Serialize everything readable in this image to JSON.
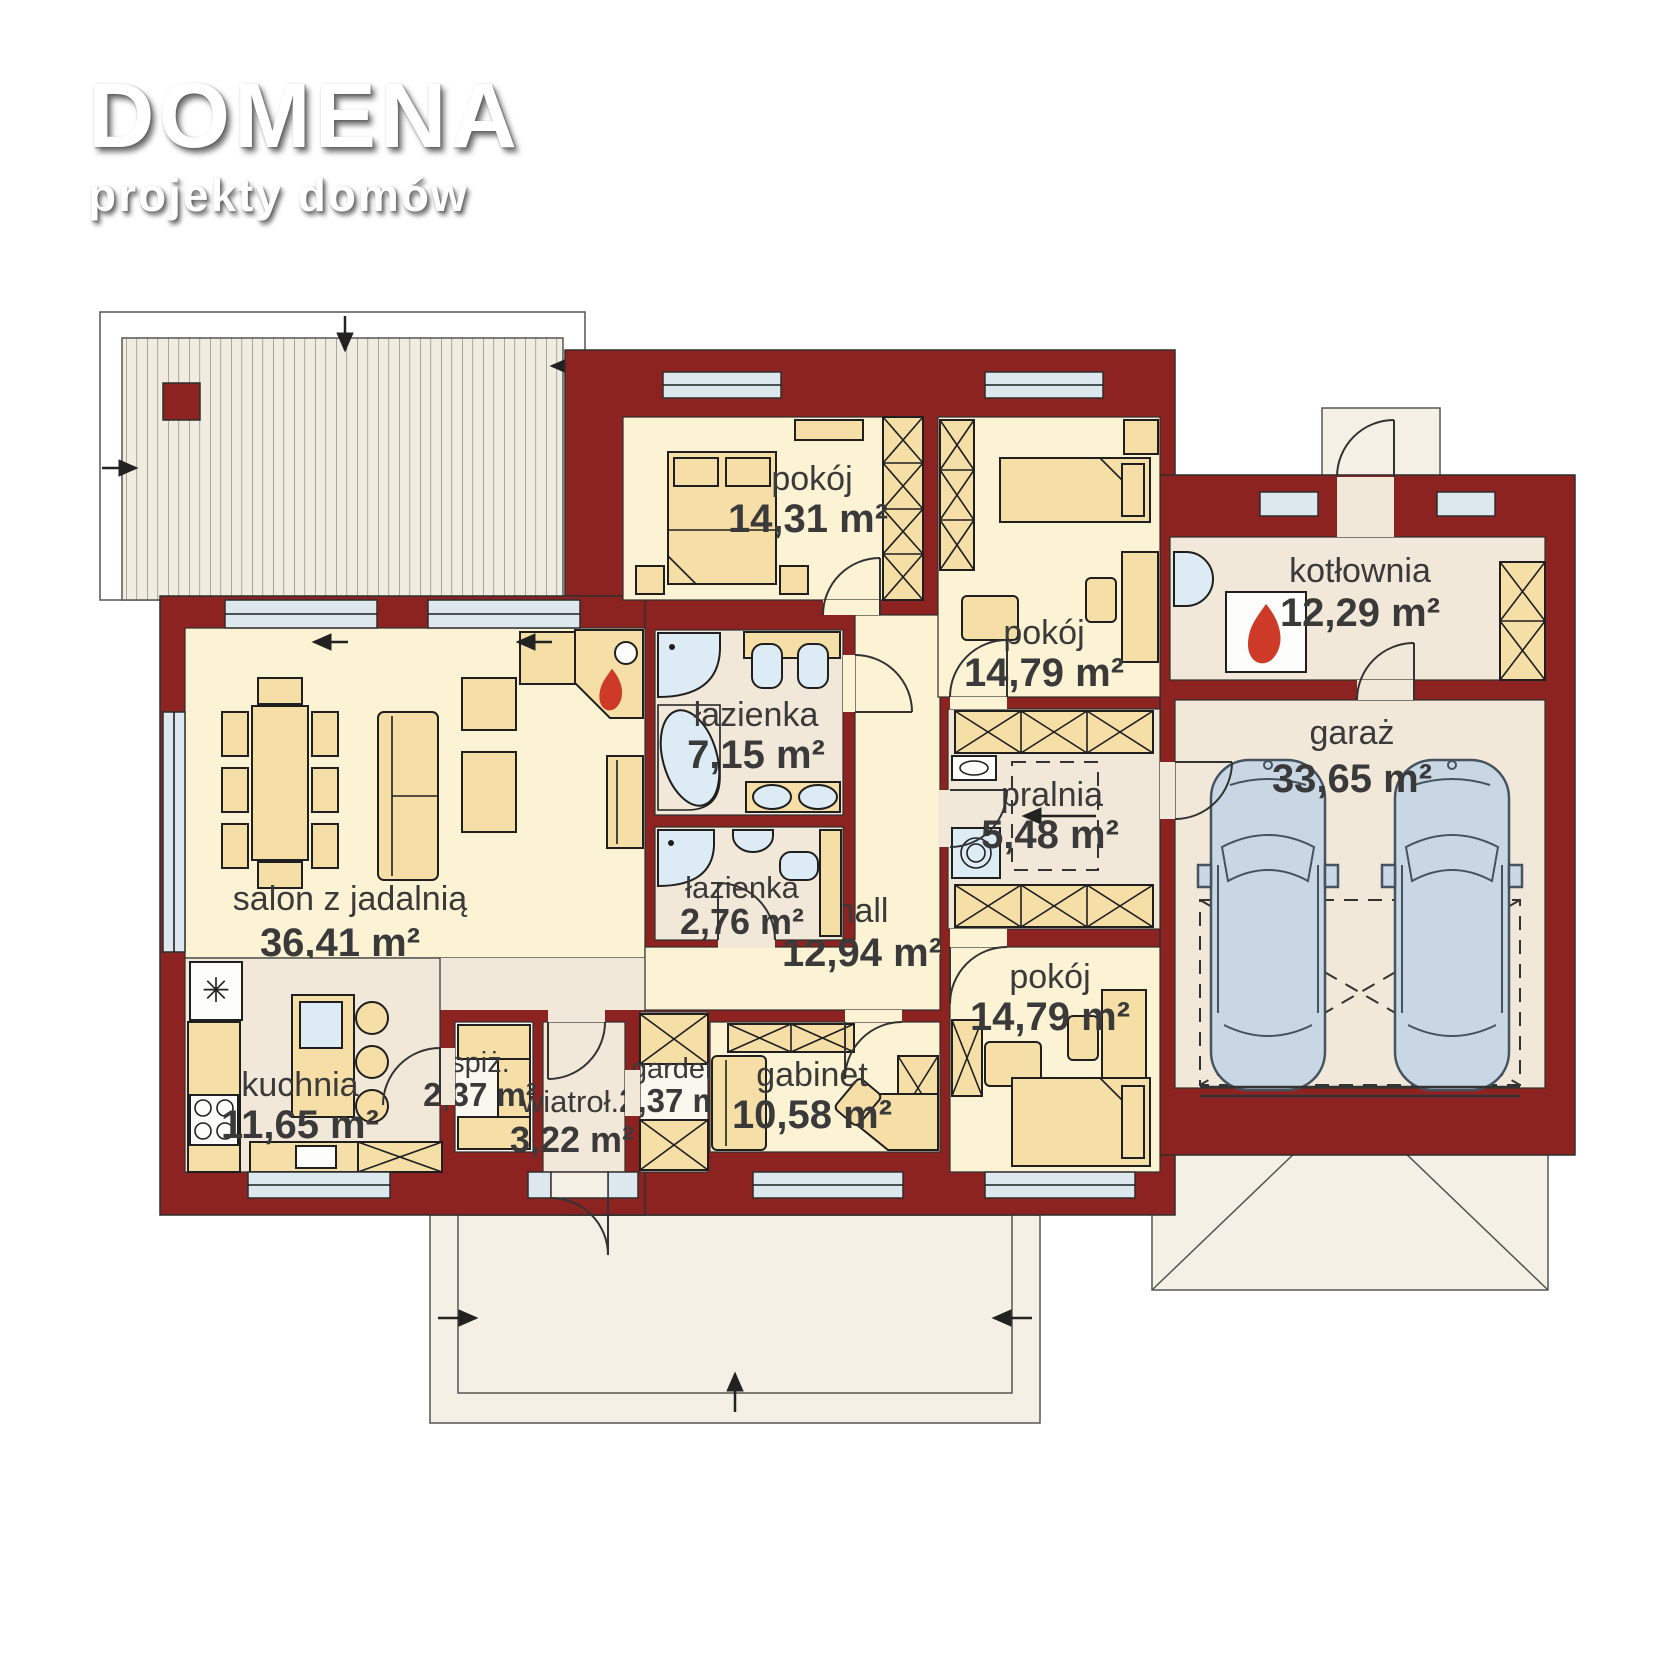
{
  "brand": {
    "name": "DOMENA",
    "tagline": "projekty domów"
  },
  "floor_plan": {
    "rooms": [
      {
        "id": "salon",
        "name": "salon z jadalnią",
        "area": "36,41 m²"
      },
      {
        "id": "kuchnia",
        "name": "kuchnia",
        "area": "11,65 m²"
      },
      {
        "id": "spizarnia",
        "name": "spiż.",
        "area": "2,37 m²"
      },
      {
        "id": "wiatrolap",
        "name": "wiatroł.",
        "area": "3,22 m²"
      },
      {
        "id": "garderoba",
        "name": "garder.",
        "area": "2,37 m²"
      },
      {
        "id": "gabinet",
        "name": "gabinet",
        "area": "10,58 m²"
      },
      {
        "id": "hall",
        "name": "hall",
        "area": "12,94 m²"
      },
      {
        "id": "lazienka",
        "name": "łazienka",
        "area": "7,15 m²"
      },
      {
        "id": "lazienka2",
        "name": "łazienka",
        "area": "2,76 m²"
      },
      {
        "id": "pokoj1",
        "name": "pokój",
        "area": "14,31 m²"
      },
      {
        "id": "pokoj2",
        "name": "pokój",
        "area": "14,79 m²"
      },
      {
        "id": "pralnia",
        "name": "pralnia",
        "area": "5,48 m²"
      },
      {
        "id": "pokoj3",
        "name": "pokój",
        "area": "14,79 m²"
      },
      {
        "id": "kotlownia",
        "name": "kotłownia",
        "area": "12,29 m²"
      },
      {
        "id": "garaz",
        "name": "garaż",
        "area": "33,65 m²"
      }
    ],
    "colors": {
      "wall": "#8D2321",
      "room_floor": "#FCF3D4",
      "service_floor": "#F1E8DA",
      "furniture": "#F6DEA7",
      "window": "#DCE8EE",
      "fixture": "#DDEBF4",
      "car": "#C8D7E3",
      "flame": "#CE3A28",
      "outdoor": "#F4F0E6"
    }
  }
}
